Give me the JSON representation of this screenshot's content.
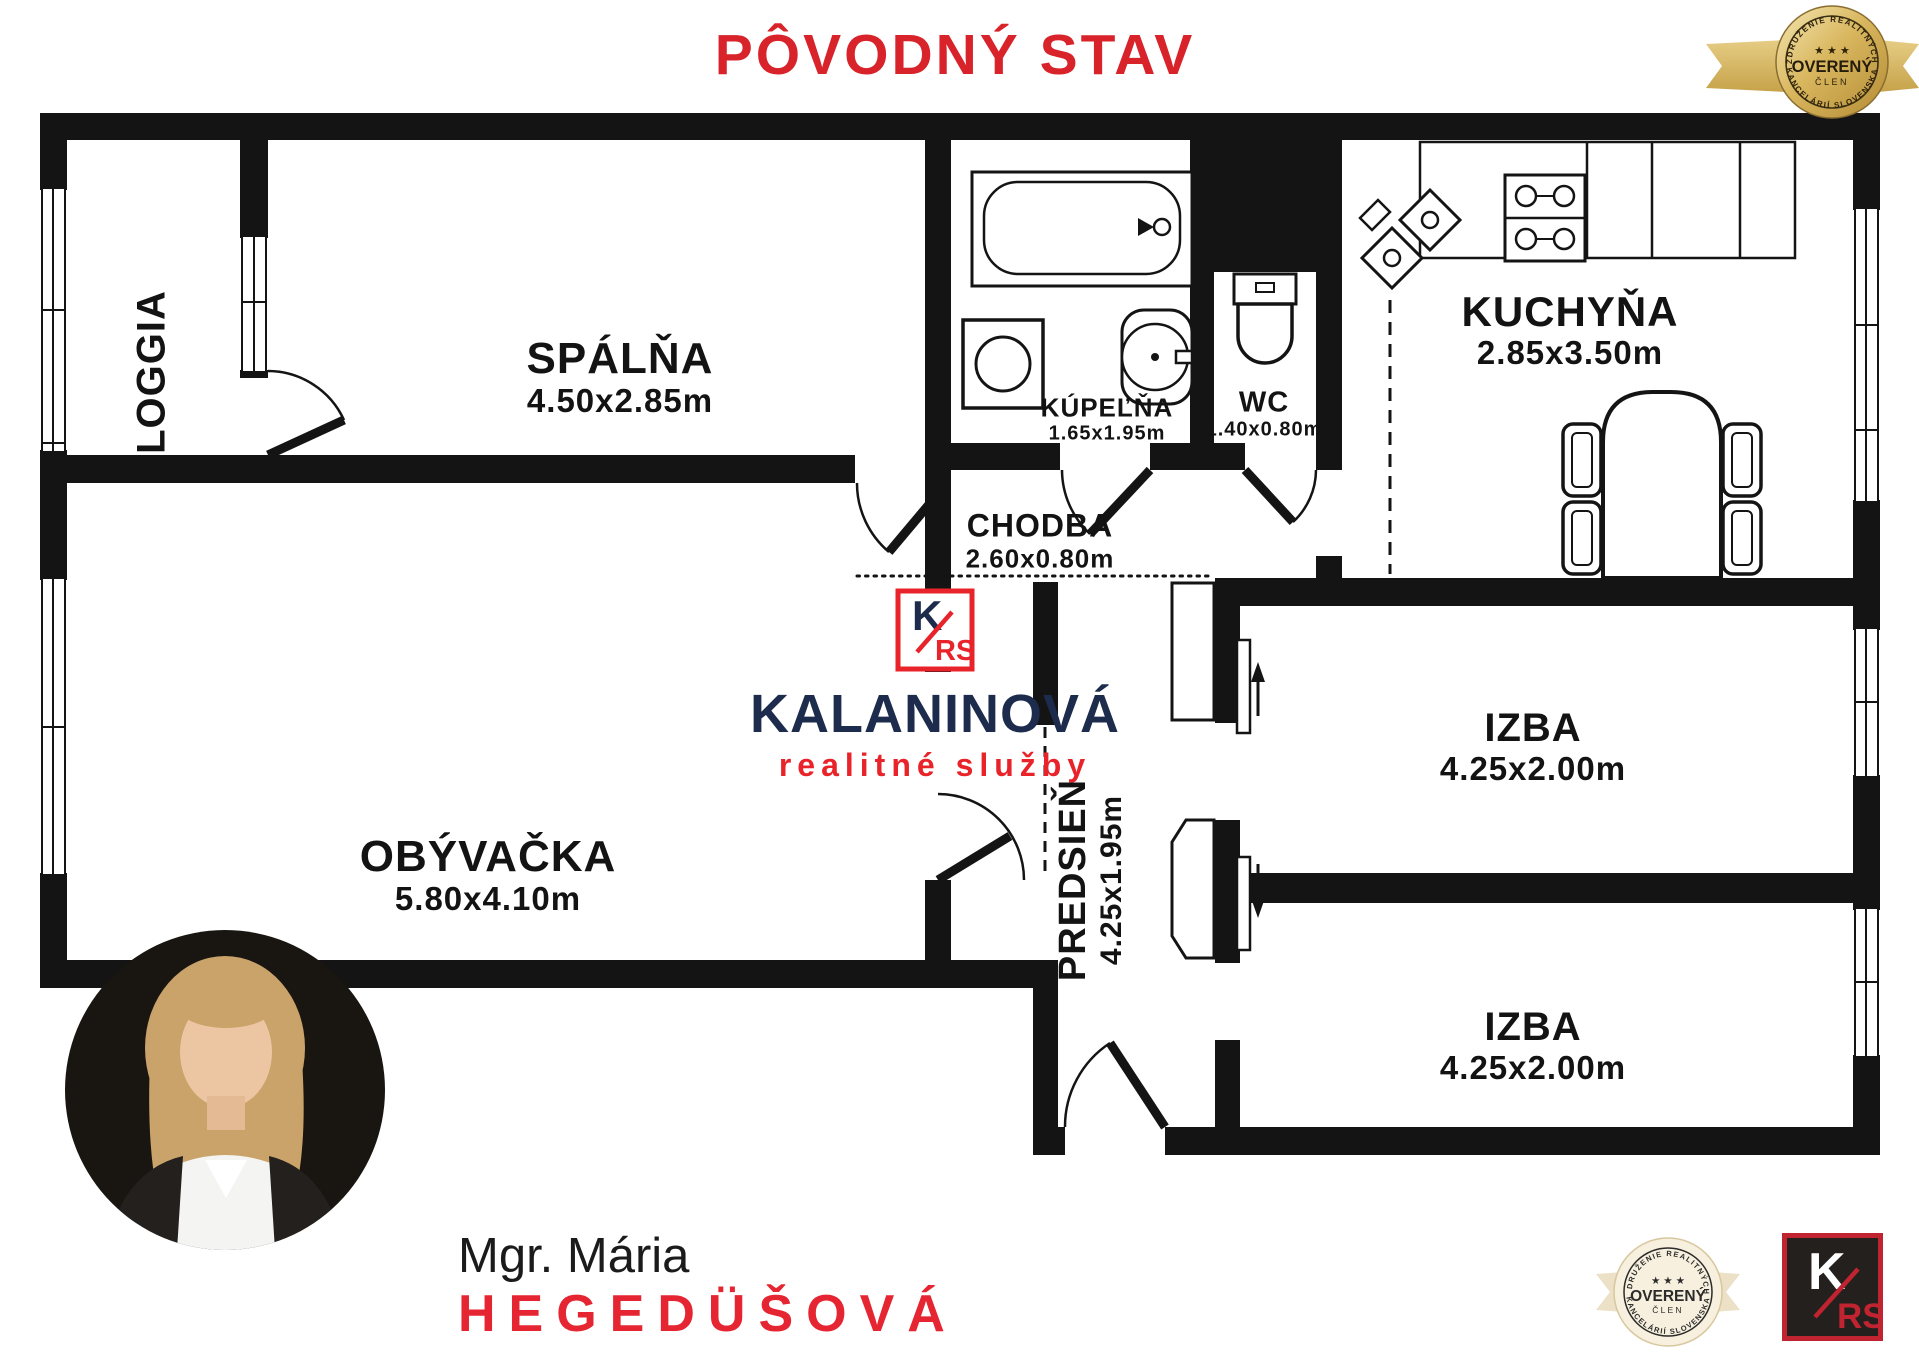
{
  "title": "PÔVODNÝ STAV",
  "badge": {
    "line_top": "ZDRUŽENIE REALITNÝCH",
    "stars": "★ ★ ★",
    "main": "OVERENÝ",
    "sub": "ČLEN",
    "line_bottom": "KANCELÁRIÍ SLOVENSKA"
  },
  "rooms": {
    "loggia": {
      "name": "LOGGIA"
    },
    "spalna": {
      "name": "SPÁLŇA",
      "dims": "4.50x2.85m"
    },
    "kupelna": {
      "name": "KÚPEĽŇA",
      "dims": "1.65x1.95m"
    },
    "wc": {
      "name": "WC",
      "dims": "1.40x0.80m"
    },
    "kuchyna": {
      "name": "KUCHYŇA",
      "dims": "2.85x3.50m"
    },
    "chodba": {
      "name": "CHODBA",
      "dims": "2.60x0.80m"
    },
    "obyvacka": {
      "name": "OBÝVAČKA",
      "dims": "5.80x4.10m"
    },
    "predsien": {
      "name": "PREDSIEŇ",
      "dims": "4.25x1.95m"
    },
    "izba_horna": {
      "name": "IZBA",
      "dims": "4.25x2.00m"
    },
    "izba_dolna": {
      "name": "IZBA",
      "dims": "4.25x2.00m"
    }
  },
  "logo": {
    "monogram_k": "K",
    "monogram_rs": "RS",
    "name": "KALANINOVÁ",
    "tagline": "realitné služby"
  },
  "agent": {
    "title_name": "Mgr. Mária",
    "surname": "HEGEDÜŠOVÁ"
  },
  "colors": {
    "accent_red": "#d8232a",
    "navy": "#1d2b4c",
    "wall_black": "#141414",
    "badge_gold": "#cda44a",
    "badge_beige": "#f7f0de"
  }
}
